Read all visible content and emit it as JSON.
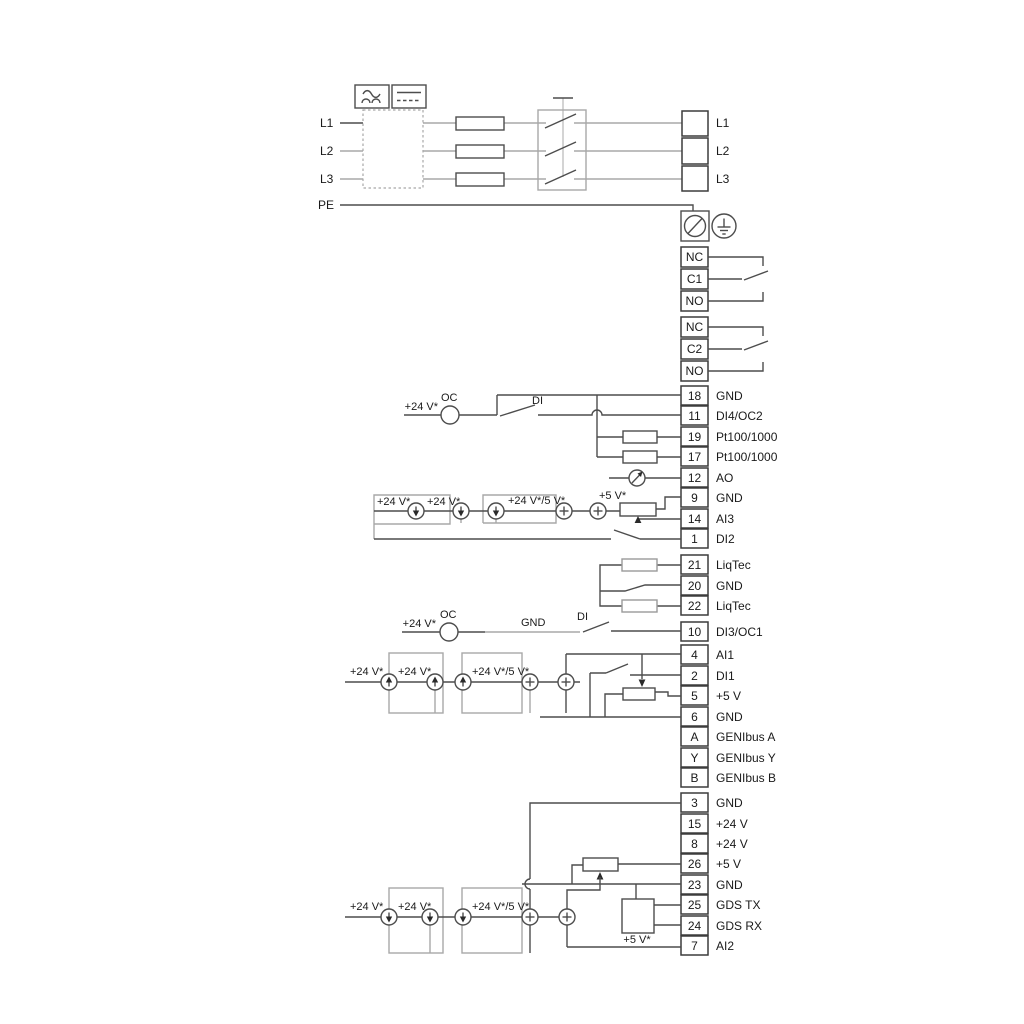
{
  "power_input": {
    "left_labels": [
      "L1",
      "L2",
      "L3",
      "PE"
    ],
    "output_labels": [
      "L1",
      "L2",
      "L3"
    ]
  },
  "relays": [
    {
      "terminals": [
        "NC",
        "C1",
        "NO"
      ]
    },
    {
      "terminals": [
        "NC",
        "C2",
        "NO"
      ]
    }
  ],
  "terminal_groups": {
    "io_top": [
      {
        "no": "18",
        "label": "GND"
      },
      {
        "no": "11",
        "label": "DI4/OC2"
      },
      {
        "no": "19",
        "label": "Pt100/1000"
      },
      {
        "no": "17",
        "label": "Pt100/1000"
      },
      {
        "no": "12",
        "label": "AO"
      },
      {
        "no": "9",
        "label": "GND"
      },
      {
        "no": "14",
        "label": "AI3"
      },
      {
        "no": "1",
        "label": "DI2"
      }
    ],
    "liqtec": [
      {
        "no": "21",
        "label": "LiqTec"
      },
      {
        "no": "20",
        "label": "GND"
      },
      {
        "no": "22",
        "label": "LiqTec"
      }
    ],
    "io_mid": [
      {
        "no": "10",
        "label": "DI3/OC1"
      },
      {
        "no": "4",
        "label": "AI1"
      },
      {
        "no": "2",
        "label": "DI1"
      },
      {
        "no": "5",
        "label": "+5 V"
      },
      {
        "no": "6",
        "label": "GND"
      },
      {
        "no": "A",
        "label": "GENIbus A"
      },
      {
        "no": "Y",
        "label": "GENIbus Y"
      },
      {
        "no": "B",
        "label": "GENIbus B"
      }
    ],
    "io_bottom": [
      {
        "no": "3",
        "label": "GND"
      },
      {
        "no": "15",
        "label": "+24 V"
      },
      {
        "no": "8",
        "label": "+24 V"
      },
      {
        "no": "26",
        "label": "+5 V"
      },
      {
        "no": "23",
        "label": "GND"
      },
      {
        "no": "25",
        "label": "GDS TX"
      },
      {
        "no": "24",
        "label": "GDS RX"
      },
      {
        "no": "7",
        "label": "AI2"
      }
    ]
  },
  "annotations": {
    "v24": "+24 V*",
    "v24_5": "+24 V*/5 V*",
    "v5": "+5 V*",
    "oc": "OC",
    "di": "DI",
    "gnd": "GND"
  },
  "colors": {
    "wire_gray": "#a8a8a8",
    "wire_dark": "#4d4d4d",
    "text": "#1a1a1a"
  }
}
